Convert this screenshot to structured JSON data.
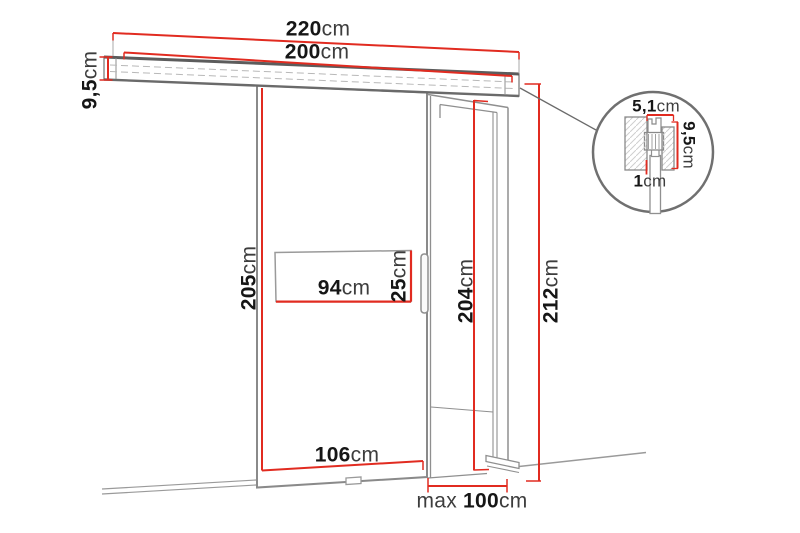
{
  "dimensions": {
    "rail_total_width": {
      "num": "220",
      "unit": "cm"
    },
    "rail_inner_width": {
      "num": "200",
      "unit": "cm"
    },
    "rail_height": {
      "num": "9,5",
      "unit": "cm"
    },
    "door_height": {
      "num": "205",
      "unit": "cm"
    },
    "window_width": {
      "num": "94",
      "unit": "cm"
    },
    "window_height": {
      "num": "25",
      "unit": "cm"
    },
    "opening_height": {
      "num": "204",
      "unit": "cm"
    },
    "total_height": {
      "num": "212",
      "unit": "cm"
    },
    "door_width": {
      "num": "106",
      "unit": "cm"
    },
    "max_opening_width": {
      "prefix": "max",
      "num": "100",
      "unit": "cm"
    },
    "detail": {
      "hanger_width": {
        "num": "5,1",
        "unit": "cm"
      },
      "hanger_height": {
        "num": "9,5",
        "unit": "cm"
      },
      "panel_thickness": {
        "num": "1",
        "unit": "cm"
      }
    }
  },
  "colors": {
    "dimension_red": "#e12b20",
    "outline_gray": "#8f8f8f",
    "dark_gray": "#5c5c5c",
    "hatch_gray": "#c9c9c9",
    "background": "#ffffff"
  }
}
